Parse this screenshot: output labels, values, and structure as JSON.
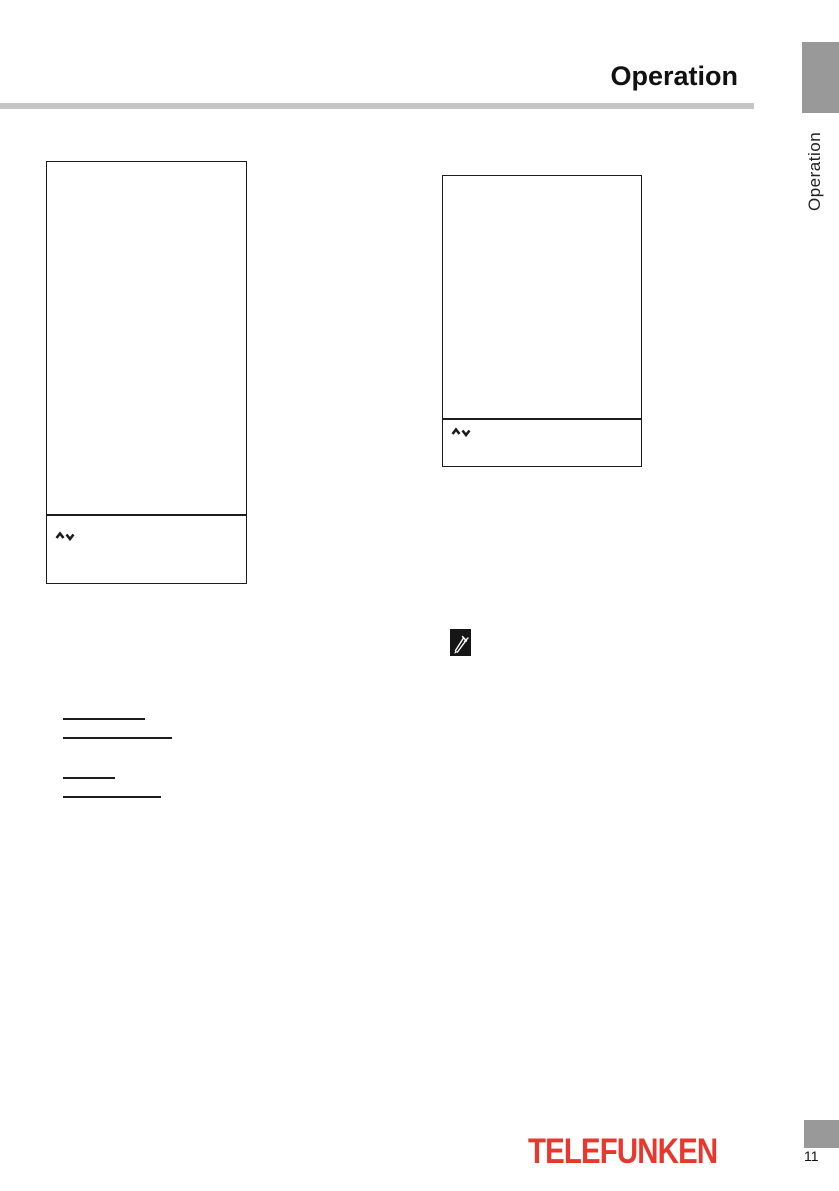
{
  "page": {
    "header_title": "Operation",
    "page_number": "11"
  },
  "side_tab": {
    "label": "Operation"
  },
  "footer": {
    "brand_logo_text": "TELEFUNKEN"
  },
  "osd_boxes": [
    {
      "name": "left-osd-box",
      "nav_icons": [
        "up-chevron-icon",
        "down-chevron-icon"
      ]
    },
    {
      "name": "right-osd-box",
      "nav_icons": [
        "up-chevron-icon",
        "down-chevron-icon"
      ]
    }
  ],
  "icons": {
    "note": "note-pencil-icon"
  },
  "colors": {
    "brand_red": "#E8372C",
    "tab_gray": "#999999",
    "rule_gray": "#C5C5C7",
    "ink_black": "#1C1C1C"
  }
}
